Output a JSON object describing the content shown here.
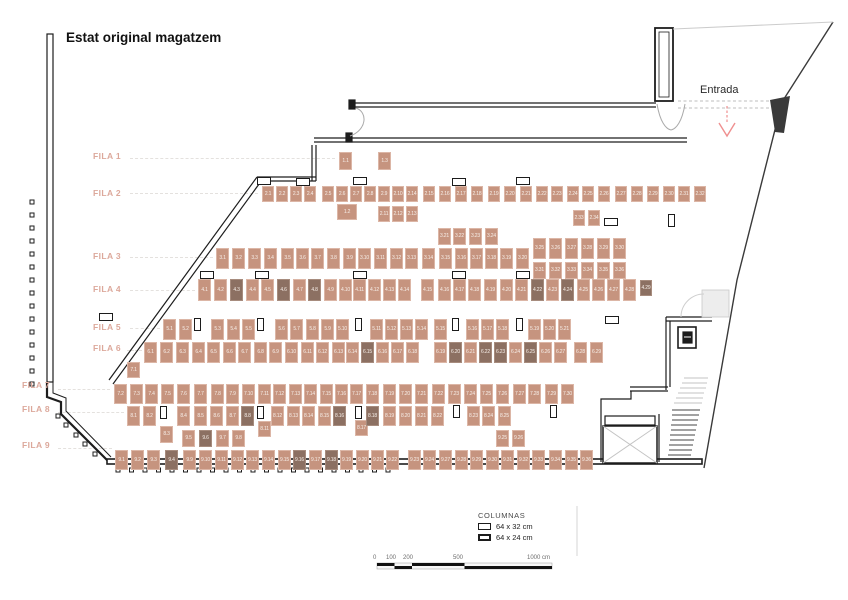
{
  "title": "Estat original magatzem",
  "entrance": {
    "label": "Entrada"
  },
  "legend": {
    "title": "COLUMNAS",
    "items": [
      {
        "label": "64 x 32 cm"
      },
      {
        "label": "64 x 24 cm"
      }
    ]
  },
  "scale_bar": {
    "labels": [
      "0",
      "100",
      "200",
      "500",
      "1000 cm"
    ]
  },
  "colors": {
    "box_fill": "#c6947f",
    "box_dark": "#8c7062",
    "box_border": "#dcb6a6",
    "row_label": "#dca89b",
    "arrow": "#ef8f8f",
    "wall": "#1d1d1d"
  },
  "columns": {
    "c64x32": [
      [
        257,
        177
      ],
      [
        296,
        178
      ],
      [
        353,
        177
      ],
      [
        452,
        178
      ],
      [
        516,
        177
      ],
      [
        604,
        218
      ],
      [
        200,
        271
      ],
      [
        255,
        271
      ],
      [
        353,
        271
      ],
      [
        452,
        271
      ],
      [
        516,
        271
      ],
      [
        99,
        313
      ],
      [
        605,
        316
      ]
    ],
    "c64x24": [
      [
        668,
        214
      ],
      [
        194,
        318
      ],
      [
        257,
        318
      ],
      [
        355,
        318
      ],
      [
        452,
        318
      ],
      [
        516,
        318
      ],
      [
        160,
        406
      ],
      [
        257,
        406
      ],
      [
        355,
        406
      ],
      [
        453,
        405
      ],
      [
        550,
        405
      ]
    ]
  },
  "rows": [
    {
      "label": "FILA 1",
      "lx": 93,
      "ly": 151,
      "y": 152,
      "h": 18,
      "w": 13,
      "boxes": [
        {
          "l": "1.1",
          "x": 339
        },
        {
          "l": "1.2",
          "x": 337,
          "y": 204,
          "w": 20,
          "h": 16
        },
        {
          "l": "1.3",
          "x": 378
        }
      ]
    },
    {
      "label": "FILA 2",
      "lx": 93,
      "ly": 188,
      "y": 186,
      "h": 16,
      "w": 12,
      "boxes": [
        {
          "l": "2.1",
          "x": 262
        },
        {
          "l": "2.2",
          "x": 276
        },
        {
          "l": "2.3",
          "x": 290
        },
        {
          "l": "2.4",
          "x": 304
        },
        {
          "l": "2.5",
          "x": 322
        },
        {
          "l": "2.6",
          "x": 336
        },
        {
          "l": "2.7",
          "x": 350
        },
        {
          "l": "2.8",
          "x": 364
        },
        {
          "l": "2.9",
          "x": 378
        },
        {
          "l": "2.10",
          "x": 392
        },
        {
          "l": "2.11",
          "x": 378,
          "y": 206
        },
        {
          "l": "2.12",
          "x": 392,
          "y": 206
        },
        {
          "l": "2.13",
          "x": 406,
          "y": 206
        },
        {
          "l": "2.14",
          "x": 406
        },
        {
          "l": "2.15",
          "x": 423
        },
        {
          "l": "2.16",
          "x": 439
        },
        {
          "l": "2.17",
          "x": 455
        },
        {
          "l": "2.18",
          "x": 471
        },
        {
          "l": "2.19",
          "x": 488
        },
        {
          "l": "2.20",
          "x": 504
        },
        {
          "l": "2.21",
          "x": 520
        },
        {
          "l": "2.22",
          "x": 536
        },
        {
          "l": "2.23",
          "x": 551
        },
        {
          "l": "2.24",
          "x": 567
        },
        {
          "l": "2.25",
          "x": 582
        },
        {
          "l": "2.26",
          "x": 598
        },
        {
          "l": "2.27",
          "x": 615
        },
        {
          "l": "2.28",
          "x": 631
        },
        {
          "l": "2.29",
          "x": 647
        },
        {
          "l": "2.30",
          "x": 663
        },
        {
          "l": "2.31",
          "x": 678
        },
        {
          "l": "2.32",
          "x": 694
        },
        {
          "l": "2.33",
          "x": 573,
          "y": 210
        },
        {
          "l": "2.34",
          "x": 588,
          "y": 210
        }
      ]
    },
    {
      "label": "FILA 3",
      "lx": 93,
      "ly": 251,
      "y": 248,
      "h": 21,
      "w": 13,
      "boxes": [
        {
          "l": "3.1",
          "x": 216
        },
        {
          "l": "3.2",
          "x": 232
        },
        {
          "l": "3.3",
          "x": 248
        },
        {
          "l": "3.4",
          "x": 264
        },
        {
          "l": "3.5",
          "x": 281
        },
        {
          "l": "3.6",
          "x": 296
        },
        {
          "l": "3.7",
          "x": 311
        },
        {
          "l": "3.8",
          "x": 327
        },
        {
          "l": "3.9",
          "x": 343
        },
        {
          "l": "3.10",
          "x": 358
        },
        {
          "l": "3.11",
          "x": 374
        },
        {
          "l": "3.12",
          "x": 390
        },
        {
          "l": "3.13",
          "x": 405
        },
        {
          "l": "3.14",
          "x": 422
        },
        {
          "l": "3.15",
          "x": 439
        },
        {
          "l": "3.16",
          "x": 455
        },
        {
          "l": "3.17",
          "x": 470
        },
        {
          "l": "3.18",
          "x": 485
        },
        {
          "l": "3.19",
          "x": 500
        },
        {
          "l": "3.20",
          "x": 516
        },
        {
          "l": "3.21",
          "x": 438,
          "y": 228,
          "h": 17
        },
        {
          "l": "3.22",
          "x": 453,
          "y": 228,
          "h": 17
        },
        {
          "l": "3.23",
          "x": 469,
          "y": 228,
          "h": 17
        },
        {
          "l": "3.24",
          "x": 485,
          "y": 228,
          "h": 17
        },
        {
          "l": "3.25",
          "x": 533,
          "y": 238
        },
        {
          "l": "3.26",
          "x": 549,
          "y": 238
        },
        {
          "l": "3.27",
          "x": 565,
          "y": 238
        },
        {
          "l": "3.28",
          "x": 581,
          "y": 238
        },
        {
          "l": "3.29",
          "x": 597,
          "y": 238
        },
        {
          "l": "3.30",
          "x": 613,
          "y": 238
        },
        {
          "l": "3.31",
          "x": 533,
          "y": 262,
          "h": 17
        },
        {
          "l": "3.32",
          "x": 549,
          "y": 262,
          "h": 17
        },
        {
          "l": "3.33",
          "x": 565,
          "y": 262,
          "h": 17
        },
        {
          "l": "3.34",
          "x": 581,
          "y": 262,
          "h": 17
        },
        {
          "l": "3.35",
          "x": 597,
          "y": 262,
          "h": 17
        },
        {
          "l": "3.36",
          "x": 613,
          "y": 262,
          "h": 17
        }
      ]
    },
    {
      "label": "FILA 4",
      "lx": 93,
      "ly": 284,
      "y": 279,
      "h": 22,
      "w": 13,
      "boxes": [
        {
          "l": "4.1",
          "x": 198
        },
        {
          "l": "4.2",
          "x": 214
        },
        {
          "l": "4.3",
          "x": 230,
          "d": 1
        },
        {
          "l": "4.4",
          "x": 246
        },
        {
          "l": "4.5",
          "x": 261
        },
        {
          "l": "4.6",
          "x": 277,
          "d": 1
        },
        {
          "l": "4.7",
          "x": 293
        },
        {
          "l": "4.8",
          "x": 308,
          "d": 1
        },
        {
          "l": "4.9",
          "x": 324
        },
        {
          "l": "4.10",
          "x": 339
        },
        {
          "l": "4.11",
          "x": 353
        },
        {
          "l": "4.12",
          "x": 368
        },
        {
          "l": "4.13",
          "x": 383
        },
        {
          "l": "4.14",
          "x": 398
        },
        {
          "l": "4.15",
          "x": 421
        },
        {
          "l": "4.16",
          "x": 438
        },
        {
          "l": "4.17",
          "x": 453
        },
        {
          "l": "4.18",
          "x": 468
        },
        {
          "l": "4.19",
          "x": 484
        },
        {
          "l": "4.20",
          "x": 500
        },
        {
          "l": "4.21",
          "x": 515
        },
        {
          "l": "4.22",
          "x": 531,
          "d": 1
        },
        {
          "l": "4.23",
          "x": 546
        },
        {
          "l": "4.24",
          "x": 561,
          "d": 1
        },
        {
          "l": "4.25",
          "x": 577
        },
        {
          "l": "4.26",
          "x": 592
        },
        {
          "l": "4.27",
          "x": 607
        },
        {
          "l": "4.28",
          "x": 623
        },
        {
          "l": "4.29",
          "x": 640,
          "y": 280,
          "w": 12,
          "h": 16,
          "d": 1
        }
      ]
    },
    {
      "label": "FILA 5",
      "lx": 93,
      "ly": 322,
      "y": 319,
      "h": 21,
      "w": 13,
      "boxes": [
        {
          "l": "5.1",
          "x": 163
        },
        {
          "l": "5.2",
          "x": 179
        },
        {
          "l": "5.3",
          "x": 211
        },
        {
          "l": "5.4",
          "x": 227
        },
        {
          "l": "5.5",
          "x": 242
        },
        {
          "l": "5.6",
          "x": 275
        },
        {
          "l": "5.7",
          "x": 290
        },
        {
          "l": "5.8",
          "x": 306
        },
        {
          "l": "5.9",
          "x": 321
        },
        {
          "l": "5.10",
          "x": 336
        },
        {
          "l": "5.11",
          "x": 370
        },
        {
          "l": "5.12",
          "x": 385
        },
        {
          "l": "5.13",
          "x": 400
        },
        {
          "l": "5.14",
          "x": 415
        },
        {
          "l": "5.15",
          "x": 434
        },
        {
          "l": "5.16",
          "x": 466
        },
        {
          "l": "5.17",
          "x": 481
        },
        {
          "l": "5.18",
          "x": 496
        },
        {
          "l": "5.19",
          "x": 528
        },
        {
          "l": "5.20",
          "x": 543
        },
        {
          "l": "5.21",
          "x": 558
        }
      ]
    },
    {
      "label": "FILA 6",
      "lx": 93,
      "ly": 343,
      "y": 342,
      "h": 21,
      "w": 13,
      "boxes": [
        {
          "l": "6.1",
          "x": 144
        },
        {
          "l": "6.2",
          "x": 160
        },
        {
          "l": "6.3",
          "x": 176
        },
        {
          "l": "6.4",
          "x": 192
        },
        {
          "l": "6.5",
          "x": 207
        },
        {
          "l": "6.6",
          "x": 223
        },
        {
          "l": "6.7",
          "x": 238
        },
        {
          "l": "6.8",
          "x": 254
        },
        {
          "l": "6.9",
          "x": 269
        },
        {
          "l": "6.10",
          "x": 285
        },
        {
          "l": "6.11",
          "x": 301
        },
        {
          "l": "6.12",
          "x": 316
        },
        {
          "l": "6.13",
          "x": 332
        },
        {
          "l": "6.14",
          "x": 346
        },
        {
          "l": "6.15",
          "x": 361,
          "d": 1
        },
        {
          "l": "6.16",
          "x": 376
        },
        {
          "l": "6.17",
          "x": 391
        },
        {
          "l": "6.18",
          "x": 406
        },
        {
          "l": "6.19",
          "x": 434
        },
        {
          "l": "6.20",
          "x": 449,
          "d": 1
        },
        {
          "l": "6.21",
          "x": 464
        },
        {
          "l": "6.22",
          "x": 479,
          "d": 1
        },
        {
          "l": "6.23",
          "x": 494,
          "d": 1
        },
        {
          "l": "6.24",
          "x": 509
        },
        {
          "l": "6.25",
          "x": 524,
          "d": 1
        },
        {
          "l": "6.26",
          "x": 539
        },
        {
          "l": "6.27",
          "x": 554
        },
        {
          "l": "6.28",
          "x": 574
        },
        {
          "l": "6.29",
          "x": 590
        }
      ]
    },
    {
      "label": "FILA 7",
      "lx": 22,
      "ly": 380,
      "y": 384,
      "h": 20,
      "w": 13,
      "boxes": [
        {
          "l": "7.1",
          "x": 127,
          "y": 362,
          "h": 16
        },
        {
          "l": "7.2",
          "x": 114
        },
        {
          "l": "7.3",
          "x": 130
        },
        {
          "l": "7.4",
          "x": 145
        },
        {
          "l": "7.5",
          "x": 161
        },
        {
          "l": "7.6",
          "x": 177
        },
        {
          "l": "7.7",
          "x": 194
        },
        {
          "l": "7.8",
          "x": 211
        },
        {
          "l": "7.9",
          "x": 226
        },
        {
          "l": "7.10",
          "x": 242
        },
        {
          "l": "7.11",
          "x": 258
        },
        {
          "l": "7.12",
          "x": 273
        },
        {
          "l": "7.13",
          "x": 289
        },
        {
          "l": "7.14",
          "x": 304
        },
        {
          "l": "7.15",
          "x": 320
        },
        {
          "l": "7.16",
          "x": 335
        },
        {
          "l": "7.17",
          "x": 350
        },
        {
          "l": "7.18",
          "x": 366
        },
        {
          "l": "7.19",
          "x": 383
        },
        {
          "l": "7.20",
          "x": 399
        },
        {
          "l": "7.21",
          "x": 415
        },
        {
          "l": "7.22",
          "x": 432
        },
        {
          "l": "7.23",
          "x": 448
        },
        {
          "l": "7.24",
          "x": 464
        },
        {
          "l": "7.25",
          "x": 480
        },
        {
          "l": "7.26",
          "x": 496
        },
        {
          "l": "7.27",
          "x": 513
        },
        {
          "l": "7.28",
          "x": 528
        },
        {
          "l": "7.29",
          "x": 545
        },
        {
          "l": "7.30",
          "x": 561
        }
      ]
    },
    {
      "label": "FILA 8",
      "lx": 22,
      "ly": 404,
      "y": 406,
      "h": 20,
      "w": 13,
      "boxes": [
        {
          "l": "8.1",
          "x": 127
        },
        {
          "l": "8.2",
          "x": 143
        },
        {
          "l": "8.3",
          "x": 160,
          "y": 426,
          "h": 17
        },
        {
          "l": "8.4",
          "x": 177
        },
        {
          "l": "8.5",
          "x": 194
        },
        {
          "l": "8.6",
          "x": 210
        },
        {
          "l": "8.7",
          "x": 226
        },
        {
          "l": "8.8",
          "x": 241,
          "d": 1
        },
        {
          "l": "8.11",
          "x": 258,
          "y": 421,
          "h": 16
        },
        {
          "l": "8.12",
          "x": 271
        },
        {
          "l": "8.13",
          "x": 287
        },
        {
          "l": "8.14",
          "x": 302
        },
        {
          "l": "8.15",
          "x": 318
        },
        {
          "l": "8.16",
          "x": 333,
          "d": 1
        },
        {
          "l": "8.17",
          "x": 355,
          "y": 420,
          "h": 16
        },
        {
          "l": "8.18",
          "x": 366,
          "d": 1
        },
        {
          "l": "8.19",
          "x": 383
        },
        {
          "l": "8.20",
          "x": 399
        },
        {
          "l": "8.21",
          "x": 415
        },
        {
          "l": "8.22",
          "x": 431
        },
        {
          "l": "8.23",
          "x": 467
        },
        {
          "l": "8.24",
          "x": 482
        },
        {
          "l": "8.25",
          "x": 498
        }
      ]
    },
    {
      "label": "FILA 9",
      "lx": 22,
      "ly": 440,
      "y": 450,
      "h": 20,
      "w": 13,
      "boxes": [
        {
          "l": "9.1",
          "x": 115
        },
        {
          "l": "9.2",
          "x": 131
        },
        {
          "l": "9.3",
          "x": 147
        },
        {
          "l": "9.4",
          "x": 165,
          "d": 1
        },
        {
          "l": "9.5",
          "x": 182,
          "y": 430,
          "h": 17
        },
        {
          "l": "9.6",
          "x": 199,
          "y": 430,
          "h": 17,
          "d": 1
        },
        {
          "l": "9.7",
          "x": 216,
          "y": 430,
          "h": 17
        },
        {
          "l": "9.8",
          "x": 232,
          "y": 430,
          "h": 17
        },
        {
          "l": "9.9",
          "x": 183
        },
        {
          "l": "9.10",
          "x": 199
        },
        {
          "l": "9.11",
          "x": 215
        },
        {
          "l": "9.12",
          "x": 231
        },
        {
          "l": "9.13",
          "x": 246
        },
        {
          "l": "9.14",
          "x": 262
        },
        {
          "l": "9.15",
          "x": 278
        },
        {
          "l": "9.16",
          "x": 293,
          "d": 1
        },
        {
          "l": "9.17",
          "x": 309
        },
        {
          "l": "9.18",
          "x": 325,
          "d": 1
        },
        {
          "l": "9.19",
          "x": 340
        },
        {
          "l": "9.20",
          "x": 356
        },
        {
          "l": "9.21",
          "x": 371
        },
        {
          "l": "9.22",
          "x": 386
        },
        {
          "l": "9.23",
          "x": 408
        },
        {
          "l": "9.24",
          "x": 423
        },
        {
          "l": "9.25",
          "x": 496,
          "y": 430,
          "h": 17
        },
        {
          "l": "9.26",
          "x": 512,
          "y": 430,
          "h": 17
        },
        {
          "l": "9.27",
          "x": 439
        },
        {
          "l": "9.28",
          "x": 455
        },
        {
          "l": "9.29",
          "x": 470
        },
        {
          "l": "9.30",
          "x": 486
        },
        {
          "l": "9.31",
          "x": 501
        },
        {
          "l": "9.32",
          "x": 517
        },
        {
          "l": "9.33",
          "x": 532
        },
        {
          "l": "9.34",
          "x": 549
        },
        {
          "l": "9.35",
          "x": 565
        },
        {
          "l": "9.36",
          "x": 580
        }
      ]
    }
  ]
}
